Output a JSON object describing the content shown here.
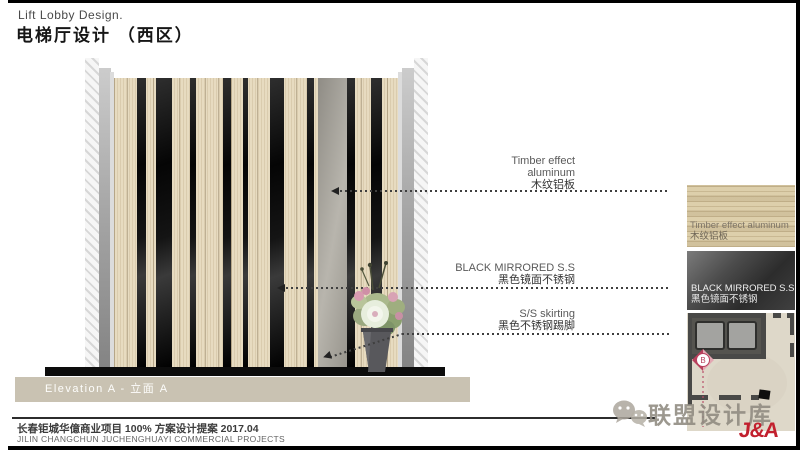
{
  "header": {
    "title_en": "Lift Lobby Design.",
    "title_zh": "电梯厅设计 （西区）"
  },
  "elevation": {
    "caption": "Elevation A - 立面 A",
    "black_strips": [
      {
        "x": 23,
        "w": 9
      },
      {
        "x": 42,
        "w": 16
      },
      {
        "x": 76,
        "w": 6
      },
      {
        "x": 109,
        "w": 8
      },
      {
        "x": 129,
        "w": 5
      },
      {
        "x": 156,
        "w": 14
      },
      {
        "x": 193,
        "w": 7
      },
      {
        "x": 233,
        "w": 8
      },
      {
        "x": 257,
        "w": 11
      }
    ]
  },
  "annotations": [
    {
      "en1": "Timber effect",
      "en2": "aluminum",
      "zh": "木纹铝板"
    },
    {
      "en1": "BLACK MIRRORED S.S",
      "zh": "黑色镜面不锈钢"
    },
    {
      "en1": "S/S skirting",
      "zh": "黑色不锈钢踢脚"
    }
  ],
  "materials": {
    "wood": {
      "en": "Timber effect aluminum",
      "zh": "木纹铝板"
    },
    "black": {
      "en": "BLACK MIRRORED S.S",
      "zh": "黑色镜面不锈钢"
    }
  },
  "plan": {
    "marker": "B"
  },
  "watermark": {
    "text": "联盟设计库",
    "brand": "J&A"
  },
  "footer": {
    "zh": "长春钜城华億商业项目  100% 方案设计提案  2017.04",
    "en": "JILIN CHANGCHUN JUCHENGHUAYI COMMERCIAL PROJECTS"
  },
  "colors": {
    "accent_red": "#c2202e",
    "marker_pink": "#b8405c",
    "wood_base": "#e7dbc0",
    "caption_bar": "#c9c2b2"
  }
}
